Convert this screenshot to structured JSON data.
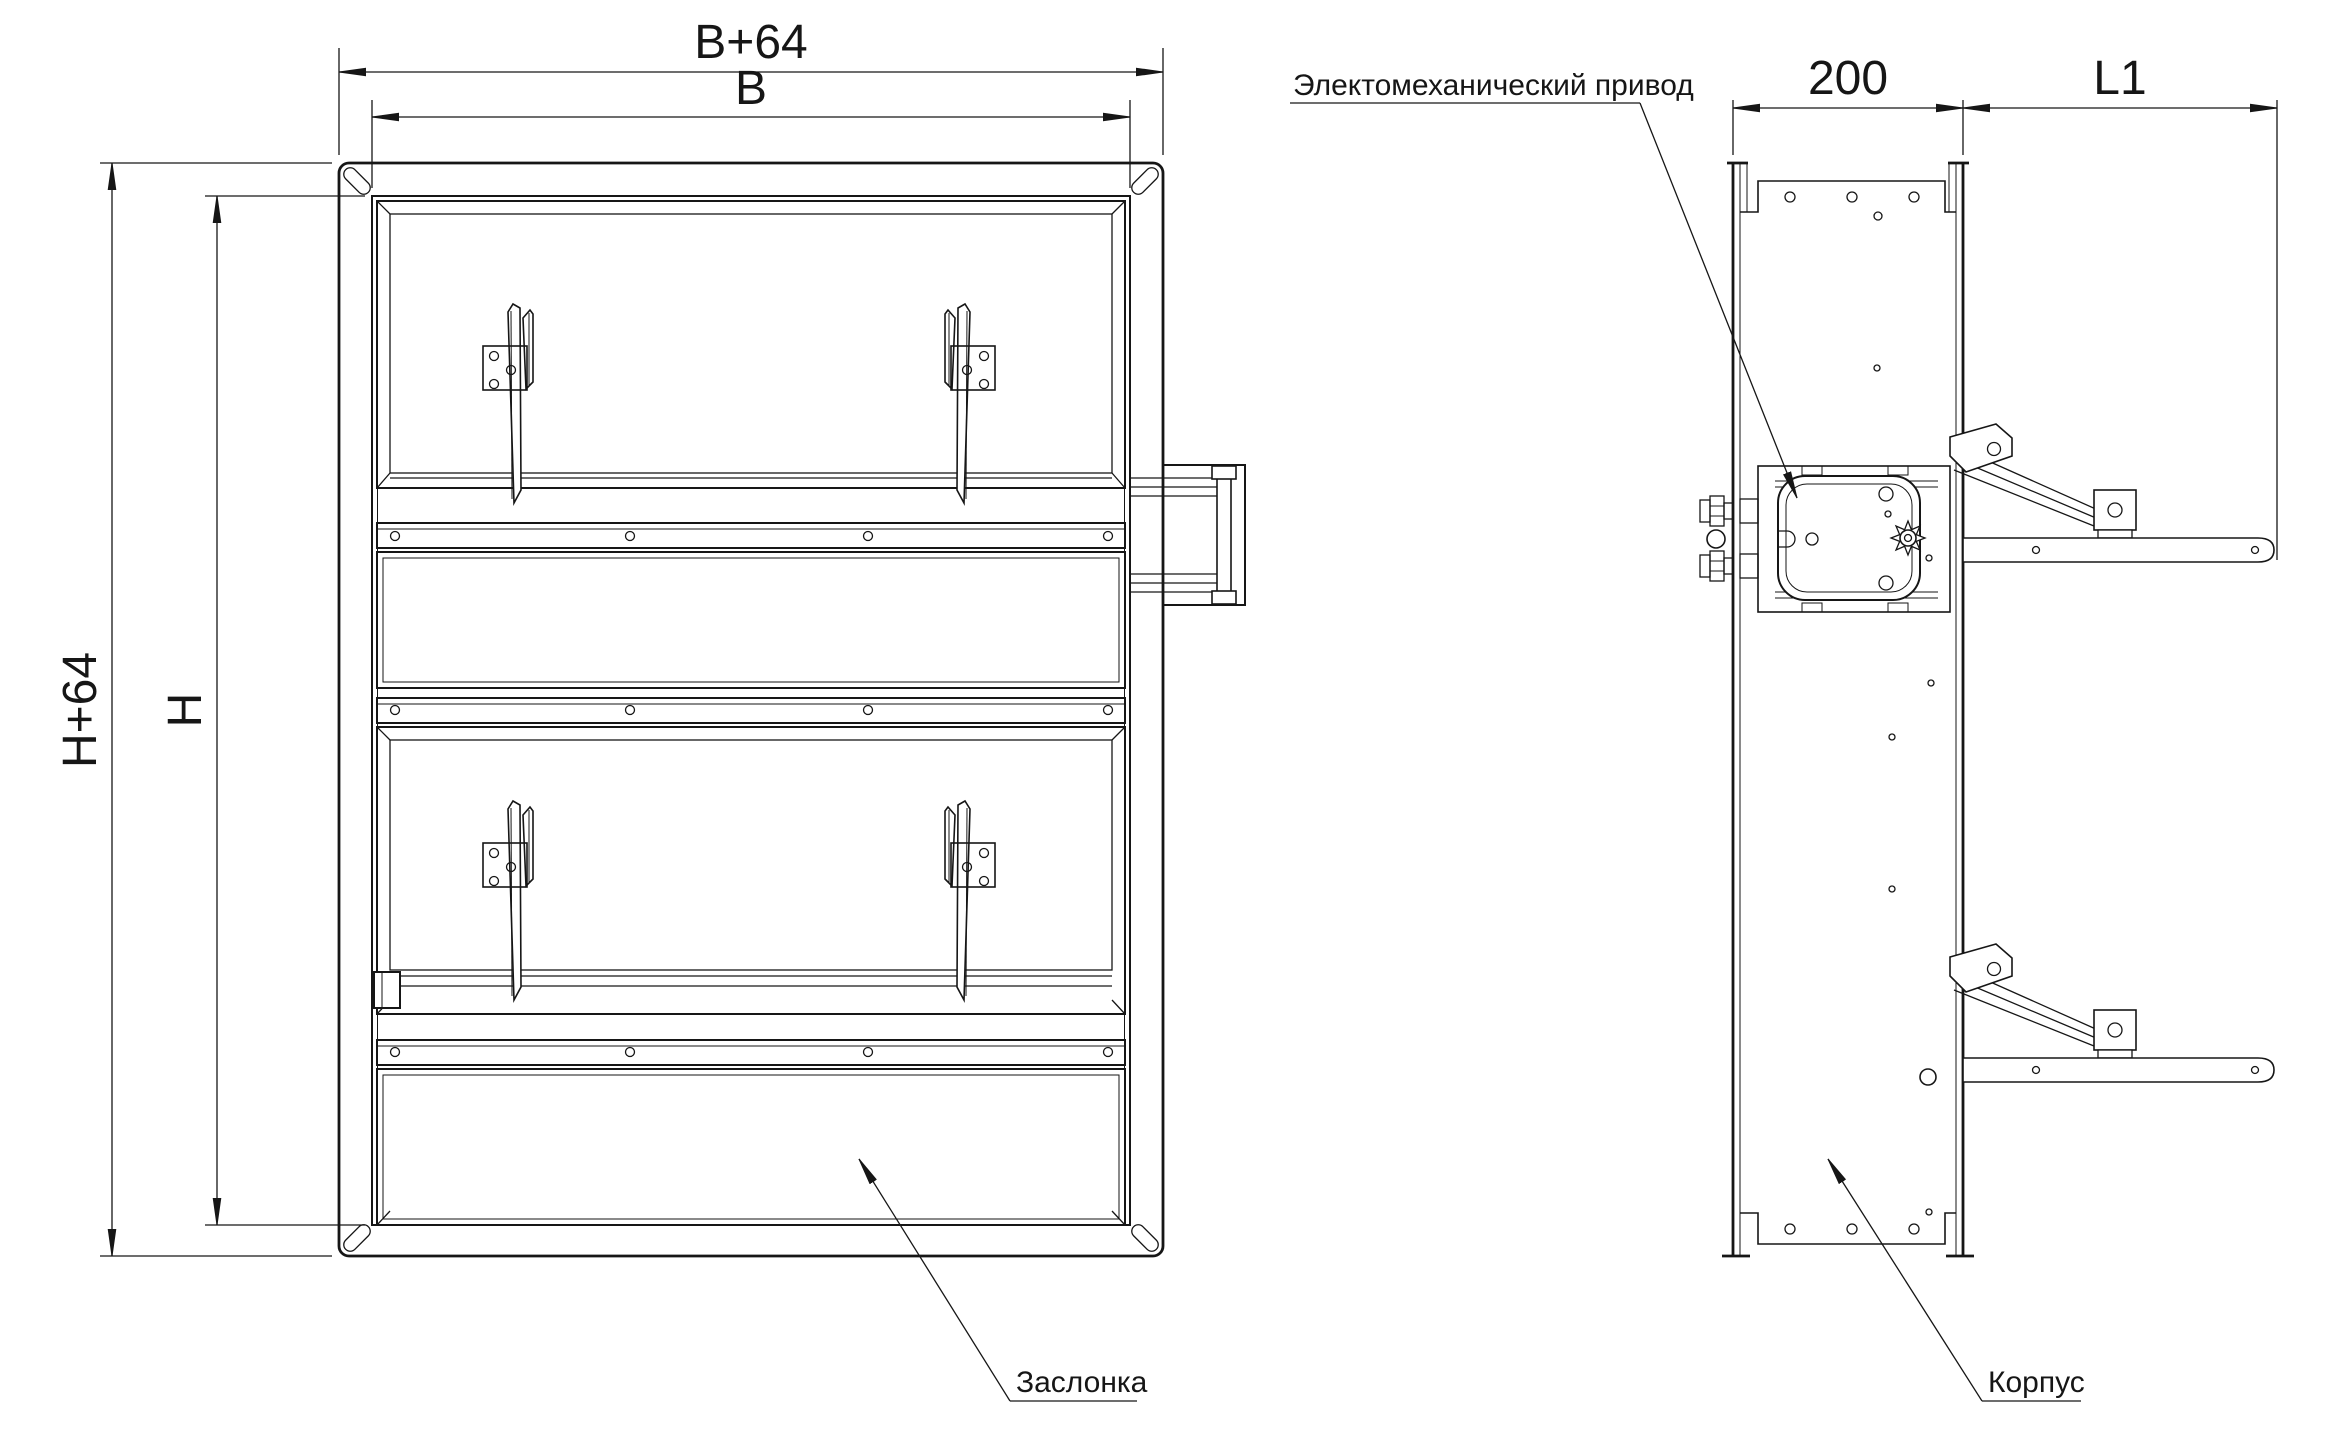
{
  "drawing": {
    "background": "#ffffff",
    "line_color": "#161616",
    "front_view": {
      "dims": {
        "width_outer": "B+64",
        "width_inner": "B",
        "height_outer": "H+64",
        "height_inner": "H"
      },
      "damper_label": "Заслонка"
    },
    "side_view": {
      "dims": {
        "depth": "200",
        "protrusion": "L1"
      },
      "actuator_label": "Электомеханический привод",
      "housing_label": "Корпус"
    }
  }
}
